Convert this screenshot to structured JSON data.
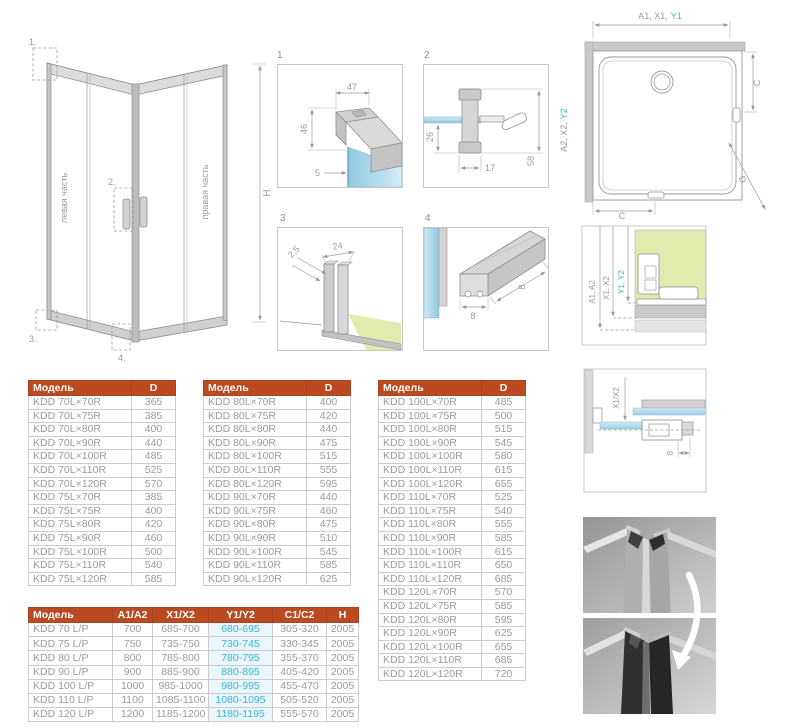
{
  "colors": {
    "header_bg": "#bb4a21",
    "header_text": "#ffffff",
    "cell_text": "#9b9b9b",
    "accent_cyan": "#3cb4d6",
    "highlight_bg": "#eaf6fb",
    "glass_blue": "#a9d6ec",
    "floor_green": "#e3eaae",
    "line_gray": "#9a9a9a"
  },
  "main_drawing": {
    "callouts": {
      "c1": "1.",
      "c2": "2.",
      "c3": "3.",
      "c4": "4."
    },
    "left_label": "левая часть",
    "right_label": "правая часть",
    "height_label": "H"
  },
  "detail_1": {
    "number": "1",
    "dims": {
      "width": "47",
      "height": "46",
      "glass": "5"
    }
  },
  "detail_2": {
    "number": "2",
    "dims": {
      "inset": "26",
      "width": "17",
      "height": "58"
    }
  },
  "detail_3": {
    "number": "3",
    "dims": {
      "gap": "2,5",
      "width": "24"
    }
  },
  "detail_4": {
    "number": "4",
    "dims": {
      "width": "8",
      "height": "8"
    }
  },
  "plan_view": {
    "top_dim_gray": "A1, X1,",
    "top_dim_cyan": "Y1",
    "side_dim_gray": "A2, X2,",
    "side_dim_cyan": "Y2",
    "dim_c_right": "C",
    "dim_c_bottom": "C",
    "dim_d": "D"
  },
  "wall_section": {
    "dim_a": "A1, A2",
    "dim_x": "X1, X2",
    "dim_y": "Y1, Y2"
  },
  "overlap_section": {
    "dim_x": "X1/X2",
    "dim_8": "8"
  },
  "tables": {
    "d1": {
      "headers": [
        "Модель",
        "D"
      ],
      "rows": [
        [
          "KDD 70L×70R",
          "365"
        ],
        [
          "KDD 70L×75R",
          "385"
        ],
        [
          "KDD 70L×80R",
          "400"
        ],
        [
          "KDD 70L×90R",
          "440"
        ],
        [
          "KDD 70L×100R",
          "485"
        ],
        [
          "KDD 70L×110R",
          "525"
        ],
        [
          "KDD 70L×120R",
          "570"
        ],
        [
          "KDD 75L×70R",
          "385"
        ],
        [
          "KDD 75L×75R",
          "400"
        ],
        [
          "KDD 75L×80R",
          "420"
        ],
        [
          "KDD 75L×90R",
          "460"
        ],
        [
          "KDD 75L×100R",
          "500"
        ],
        [
          "KDD 75L×110R",
          "540"
        ],
        [
          "KDD 75L×120R",
          "585"
        ]
      ]
    },
    "d2": {
      "headers": [
        "Модель",
        "D"
      ],
      "rows": [
        [
          "KDD 80L×70R",
          "400"
        ],
        [
          "KDD 80L×75R",
          "420"
        ],
        [
          "KDD 80L×80R",
          "440"
        ],
        [
          "KDD 80L×90R",
          "475"
        ],
        [
          "KDD 80L×100R",
          "515"
        ],
        [
          "KDD 80L×110R",
          "555"
        ],
        [
          "KDD 80L×120R",
          "595"
        ],
        [
          "KDD 90L×70R",
          "440"
        ],
        [
          "KDD 90L×75R",
          "460"
        ],
        [
          "KDD 90L×80R",
          "475"
        ],
        [
          "KDD 90L×90R",
          "510"
        ],
        [
          "KDD 90L×100R",
          "545"
        ],
        [
          "KDD 90L×110R",
          "585"
        ],
        [
          "KDD 90L×120R",
          "625"
        ]
      ]
    },
    "d3": {
      "headers": [
        "Модель",
        "D"
      ],
      "rows": [
        [
          "KDD 100L×70R",
          "485"
        ],
        [
          "KDD 100L×75R",
          "500"
        ],
        [
          "KDD 100L×80R",
          "515"
        ],
        [
          "KDD 100L×90R",
          "545"
        ],
        [
          "KDD 100L×100R",
          "580"
        ],
        [
          "KDD 100L×110R",
          "615"
        ],
        [
          "KDD 100L×120R",
          "655"
        ],
        [
          "KDD 110L×70R",
          "525"
        ],
        [
          "KDD 110L×75R",
          "540"
        ],
        [
          "KDD 110L×80R",
          "555"
        ],
        [
          "KDD 110L×90R",
          "585"
        ],
        [
          "KDD 110L×100R",
          "615"
        ],
        [
          "KDD 110L×110R",
          "650"
        ],
        [
          "KDD 110L×120R",
          "685"
        ],
        [
          "KDD 120L×70R",
          "570"
        ],
        [
          "KDD 120L×75R",
          "585"
        ],
        [
          "KDD 120L×80R",
          "595"
        ],
        [
          "KDD 120L×90R",
          "625"
        ],
        [
          "KDD 120L×100R",
          "655"
        ],
        [
          "KDD 120L×110R",
          "685"
        ],
        [
          "KDD 120L×120R",
          "720"
        ]
      ]
    },
    "sizes": {
      "headers": [
        "Модель",
        "A1/A2",
        "X1/X2",
        "Y1/Y2",
        "C1/C2",
        "H"
      ],
      "rows": [
        [
          "KDD 70 L/P",
          "700",
          "685-700",
          "680-695",
          "305-320",
          "2005"
        ],
        [
          "KDD 75 L/P",
          "750",
          "735-750",
          "730-745",
          "330-345",
          "2005"
        ],
        [
          "KDD 80 L/P",
          "800",
          "785-800",
          "780-795",
          "355-370",
          "2005"
        ],
        [
          "KDD 90 L/P",
          "900",
          "885-900",
          "880-895",
          "405-420",
          "2005"
        ],
        [
          "KDD 100 L/P",
          "1000",
          "985-1000",
          "980-995",
          "455-470",
          "2005"
        ],
        [
          "KDD 110 L/P",
          "1100",
          "1085-1100",
          "1080-1095",
          "505-520",
          "2005"
        ],
        [
          "KDD 120 L/P",
          "1200",
          "1185-1200",
          "1180-1195",
          "555-570",
          "2005"
        ]
      ]
    }
  }
}
